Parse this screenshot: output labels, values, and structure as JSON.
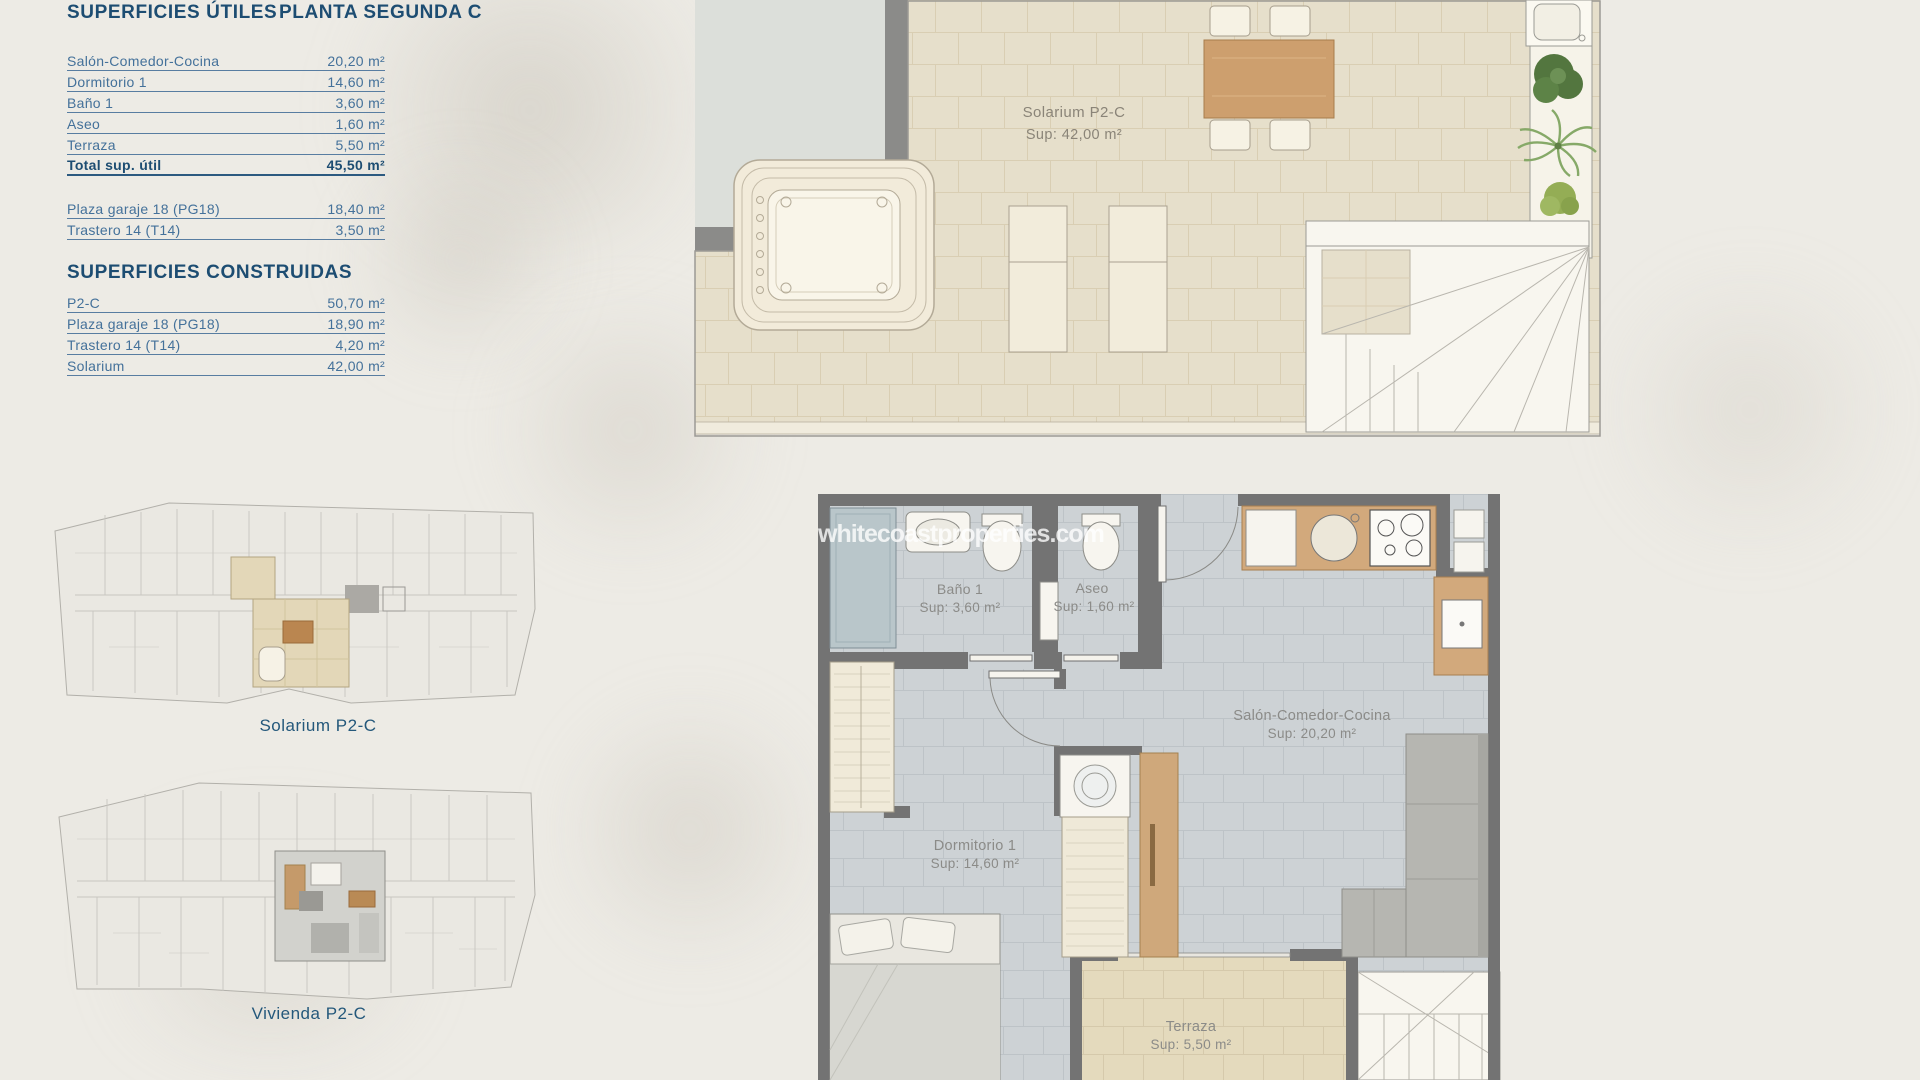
{
  "surfaces": {
    "utiles": {
      "title": "SUPERFICIES ÚTILES",
      "floor": "PLANTA SEGUNDA C",
      "rows": [
        {
          "label": "Salón-Comedor-Cocina",
          "value": "20,20 m²"
        },
        {
          "label": "Dormitorio 1",
          "value": "14,60 m²"
        },
        {
          "label": "Baño 1",
          "value": "3,60 m²"
        },
        {
          "label": "Aseo",
          "value": "1,60 m²"
        },
        {
          "label": "Terraza",
          "value": "5,50 m²"
        },
        {
          "label": "Total sup. útil",
          "value": "45,50 m²"
        }
      ],
      "annex": [
        {
          "label": "Plaza garaje 18 (PG18)",
          "value": "18,40 m²"
        },
        {
          "label": "Trastero 14 (T14)",
          "value": "3,50 m²"
        }
      ]
    },
    "construidas": {
      "title": "SUPERFICIES CONSTRUIDAS",
      "rows": [
        {
          "label": "P2-C",
          "value": "50,70 m²"
        },
        {
          "label": "Plaza garaje 18 (PG18)",
          "value": "18,90 m²"
        },
        {
          "label": "Trastero 14 (T14)",
          "value": "4,20 m²"
        },
        {
          "label": "Solarium",
          "value": "42,00 m²"
        }
      ]
    }
  },
  "solarium_plan": {
    "name": "Solarium P2-C",
    "area": "Sup: 42,00 m²"
  },
  "vivienda_plan": {
    "watermark": "whitecoastproperties.com",
    "bano": {
      "name": "Baño 1",
      "area": "Sup: 3,60 m²"
    },
    "aseo": {
      "name": "Aseo",
      "area": "Sup: 1,60 m²"
    },
    "salon": {
      "name": "Salón-Comedor-Cocina",
      "area": "Sup: 20,20 m²"
    },
    "dormitorio": {
      "name": "Dormitorio 1",
      "area": "Sup: 14,60 m²"
    },
    "terraza": {
      "name": "Terraza",
      "area": "Sup: 5,50 m²"
    }
  },
  "thumbnails": {
    "solarium_caption": "Solarium P2-C",
    "vivienda_caption": "Vivienda P2-C"
  },
  "colors": {
    "accent_blue": "#1d4d72",
    "row_blue": "#44719a",
    "wall_gray": "#737373",
    "beige_tile": "#e5decb",
    "gray_tile": "#cdd2d5",
    "wood": "#d2a97c"
  }
}
